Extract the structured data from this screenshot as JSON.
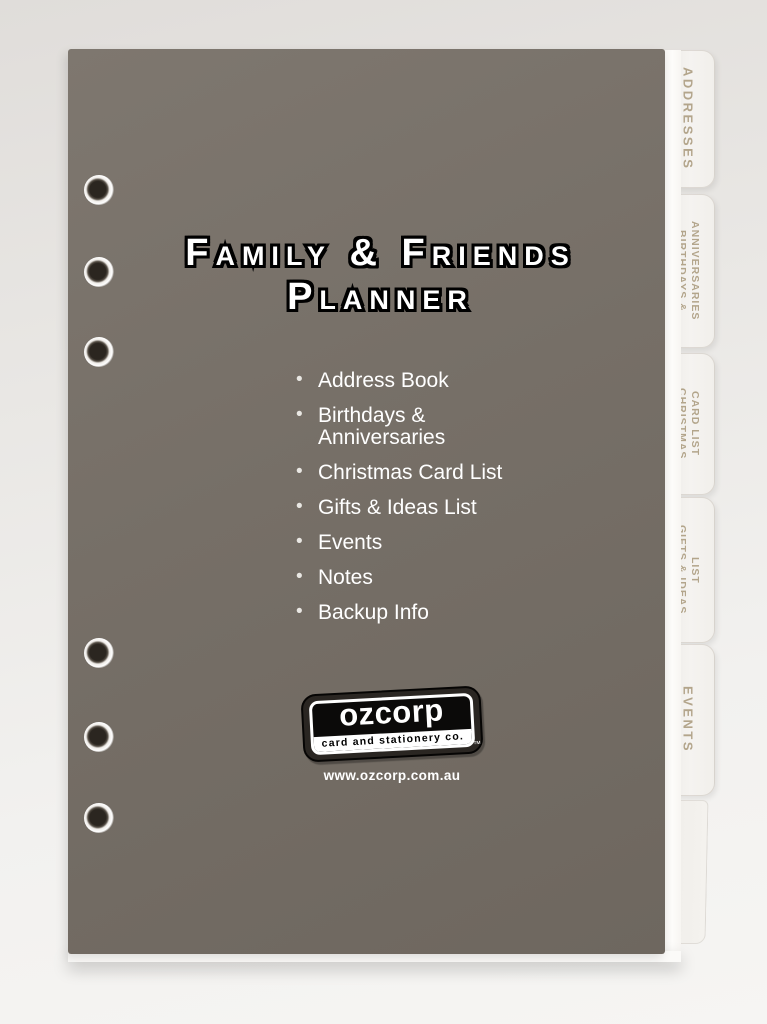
{
  "photo_subject": "Family & Friends Planner refill with index tab dividers",
  "cover": {
    "title_line1": "Family & Friends",
    "title_line2": "Planner",
    "contents": [
      "Address Book",
      "Birthdays & Anniversaries",
      "Christmas Card List",
      "Gifts & Ideas List",
      "Events",
      "Notes",
      "Backup Info"
    ],
    "logo": {
      "word": "ozcorp",
      "tagline": "card and stationery co.",
      "trademark": "™",
      "website": "www.ozcorp.com.au"
    }
  },
  "tabs": [
    {
      "lines": [
        "ADDRESSES"
      ]
    },
    {
      "lines": [
        "BIRTHDAYS &",
        "ANNIVERSARIES"
      ]
    },
    {
      "lines": [
        "CHRISTMAS",
        "CARD LIST"
      ]
    },
    {
      "lines": [
        "GIFTS & IDEAS",
        "LIST"
      ]
    },
    {
      "lines": [
        "EVENTS"
      ]
    }
  ],
  "colors": {
    "cover": "#766f67",
    "title_fill": "#ffffff",
    "title_outline": "#000000",
    "list_text": "#ffffff",
    "tab_text": "#b3a58b",
    "page_edge": "#fbfaf8",
    "background": "#ecebe8"
  }
}
